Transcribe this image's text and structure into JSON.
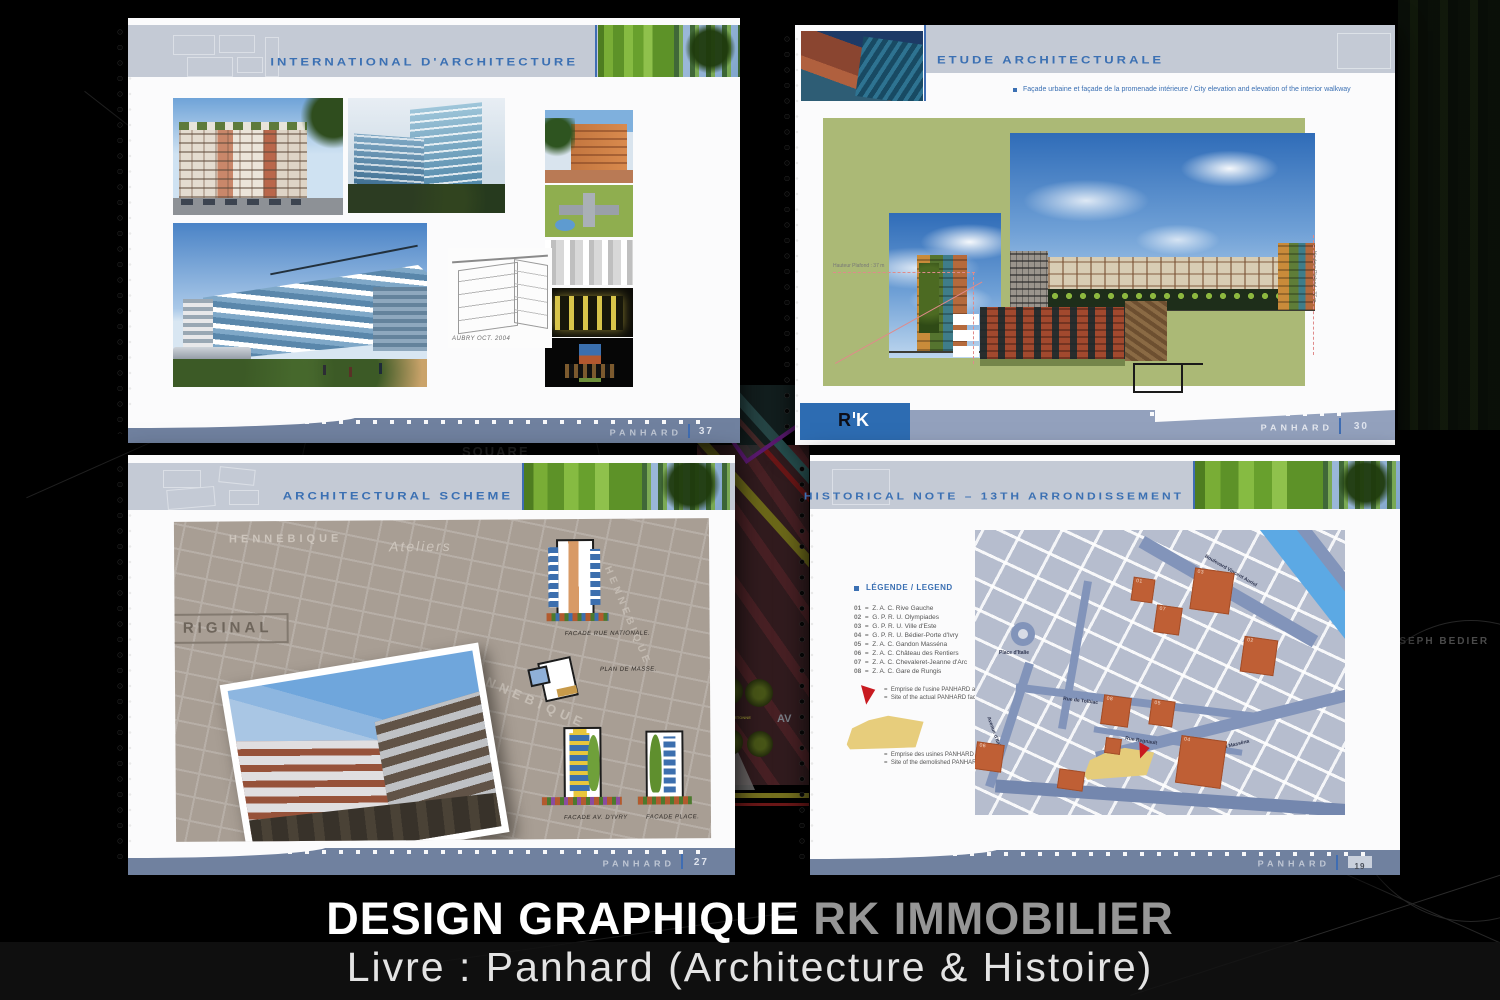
{
  "caption": {
    "line1_a": "DESIGN GRAPHIQUE",
    "line1_b": "RK IMMOBILIER",
    "line2": "Livre : Panhard (Architecture & Histoire)"
  },
  "background": {
    "square": "SQUARE",
    "bedier": "JOSEPH BEDIER",
    "av": "AV",
    "pietons": "PRINCIPAUX PIETONNE"
  },
  "brand": {
    "footer": "PANHARD"
  },
  "page1": {
    "title": "INTERNATIONAL D'ARCHITECTURE",
    "page_number": "37",
    "sketch_note": "AUBRY OCT. 2004"
  },
  "page2": {
    "title": "ETUDE ARCHITECTURALE",
    "subtitle": "Façade urbaine et façade de la promenade intérieure / City elevation and elevation of the interior walkway",
    "page_number": "30",
    "dim_label": "Hauteur Plafond : 37 m",
    "logo_r": "R",
    "logo_k": "K"
  },
  "page3": {
    "title": "ARCHITECTURAL SCHEME",
    "page_number": "27",
    "stamp": "RIGINAL",
    "blueprint_name": "HENNEBIQUE",
    "blueprint_script": "Ateliers",
    "captions": [
      "FACADE RUE NATIONALE.",
      "PLAN DE MASSE.",
      "FACADE AV. D'IVRY",
      "FACADE PLACE."
    ]
  },
  "page4": {
    "title": "HISTORICAL NOTE – 13TH ARRONDISSEMENT",
    "page_number": "19",
    "legend_title": "LÉGENDE / LEGEND",
    "eq": "=",
    "items": [
      {
        "num": "01",
        "label": "Z. A. C. Rive Gauche"
      },
      {
        "num": "02",
        "label": "G. P. R. U. Olympiades"
      },
      {
        "num": "03",
        "label": "G. P. R. U. Ville d'Este"
      },
      {
        "num": "04",
        "label": "G. P. R. U. Bédier-Porte d'Ivry"
      },
      {
        "num": "05",
        "label": "Z. A. C. Gandon Masséna"
      },
      {
        "num": "06",
        "label": "Z. A. C. Château des Rentiers"
      },
      {
        "num": "07",
        "label": "Z. A. C. Chevaleret-Jeanne d'Arc"
      },
      {
        "num": "08",
        "label": "Z. A. C. Gare de Rungis"
      }
    ],
    "actual": {
      "fr": "Emprise de l'usine PANHARD actuelle",
      "en": "Site of the actual PANHARD factory"
    },
    "demolished": {
      "fr": "Emprise des usines PANHARD démolies",
      "en": "Site of the demolished PANHARD factories"
    },
    "streets": {
      "auriol": "Boulevard Vincent Auriol",
      "place_italie": "Place d'Italie",
      "tolbiac": "Rue de Tolbiac",
      "av_italie": "Avenue d'Italie",
      "massena": "Boulevard Masséna",
      "regnault": "Rue Regnault"
    },
    "sites": [
      {
        "num": "01"
      },
      {
        "num": "03"
      },
      {
        "num": "07"
      },
      {
        "num": "02"
      },
      {
        "num": "08"
      },
      {
        "num": "05"
      },
      {
        "num": "04"
      },
      {
        "num": "06"
      }
    ]
  }
}
